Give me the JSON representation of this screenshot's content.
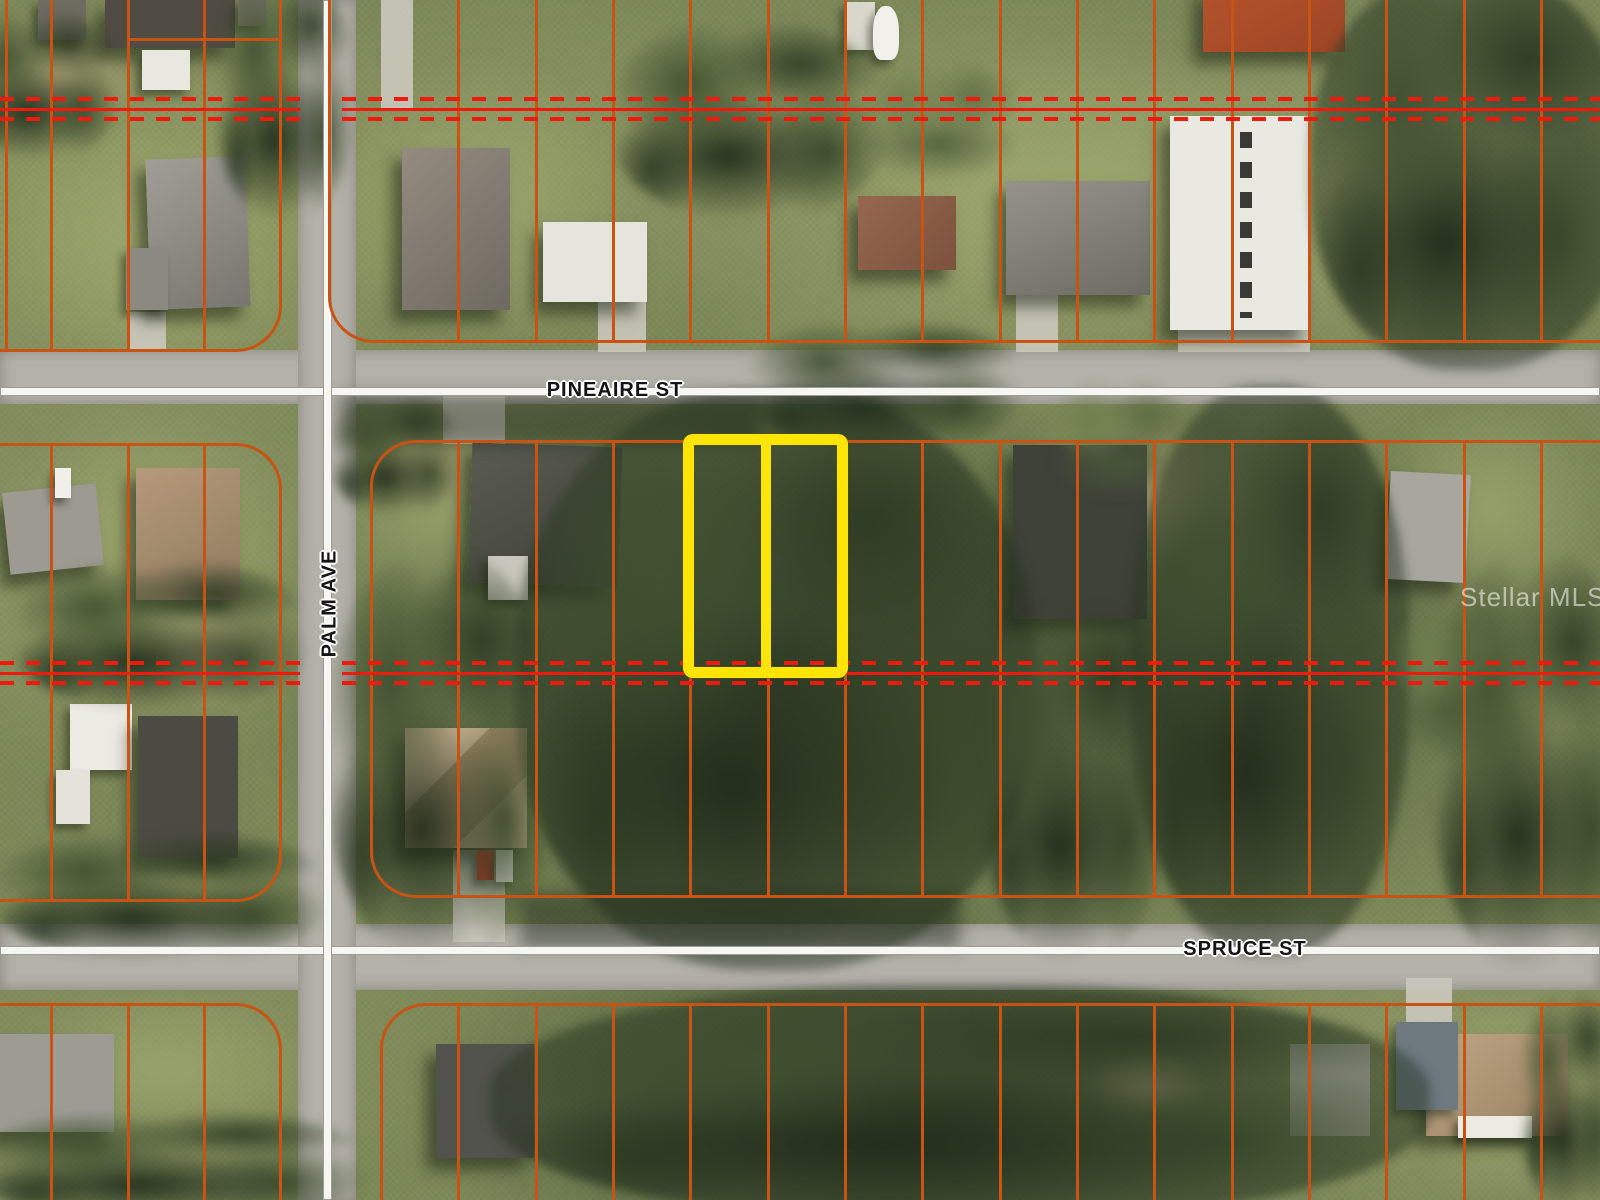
{
  "streets": {
    "pineaire": {
      "label": "PINEAIRE ST"
    },
    "palm": {
      "label": "PALM AVE"
    },
    "spruce": {
      "label": "SPRUCE ST"
    }
  },
  "watermark": {
    "label": "Stellar MLS"
  },
  "overlay_colors": {
    "lot_line": "#c85312",
    "plat_boundary": "#ee1a0e",
    "highlight": "#ffe408",
    "road_centerline": "#f6f6f2"
  }
}
